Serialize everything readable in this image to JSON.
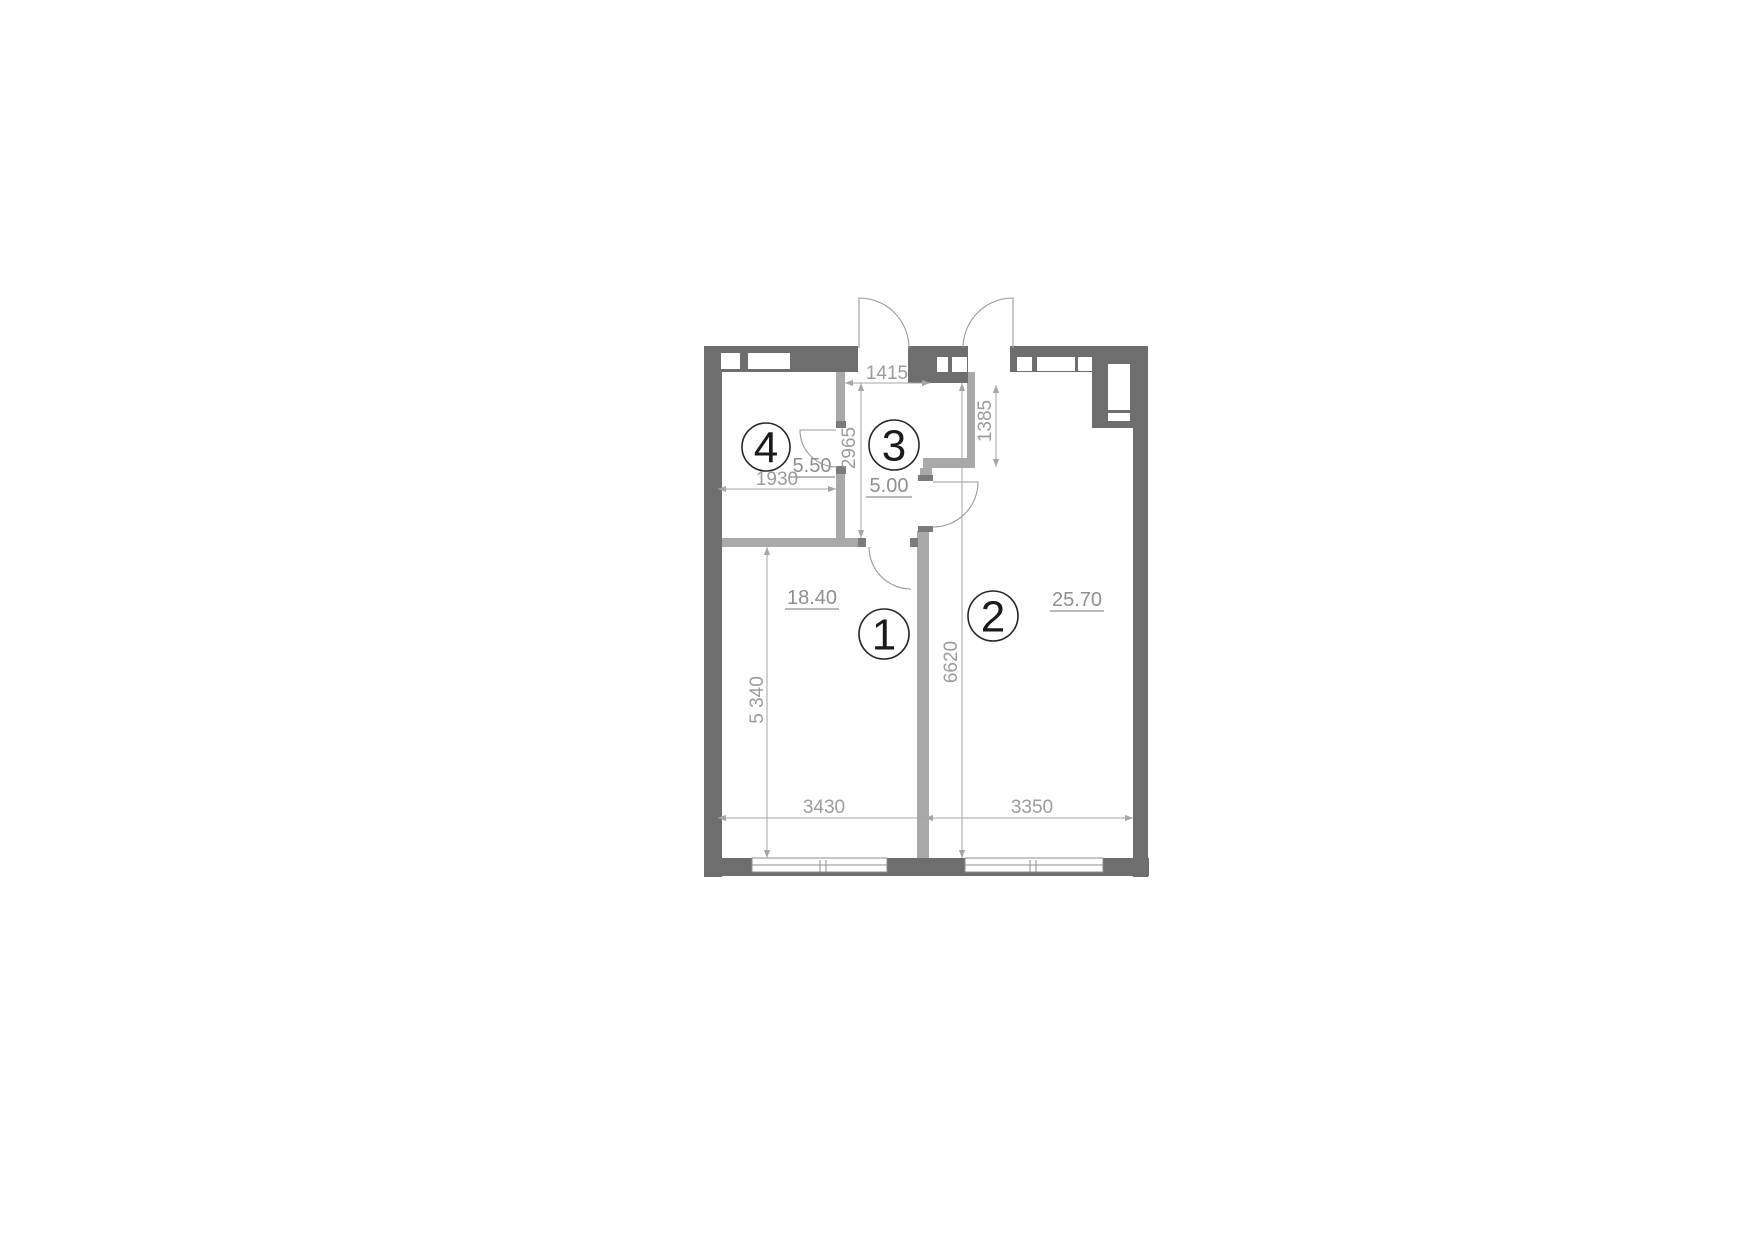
{
  "plan": {
    "rooms": [
      {
        "number": "1",
        "area": "18.40"
      },
      {
        "number": "2",
        "area": "25.70"
      },
      {
        "number": "3",
        "area": "5.00"
      },
      {
        "number": "4",
        "area": "5.50"
      }
    ],
    "dims": {
      "hall_width": "1415",
      "room4_width": "1930",
      "hall_height": "2965",
      "niche_height": "1385",
      "room2_height": "6620",
      "room1_height": "5 340",
      "room1_width": "3430",
      "room2_width": "3350"
    },
    "colors": {
      "wall_exterior": "#6e6e6e",
      "wall_interior": "#a9a9a9",
      "wall_jamb": "#7b7b7b",
      "dims": "#a6a6a6",
      "dim_text": "#9c9c9c",
      "area_text": "#8f8f8f",
      "door_arc": "#9a9a9a"
    }
  }
}
